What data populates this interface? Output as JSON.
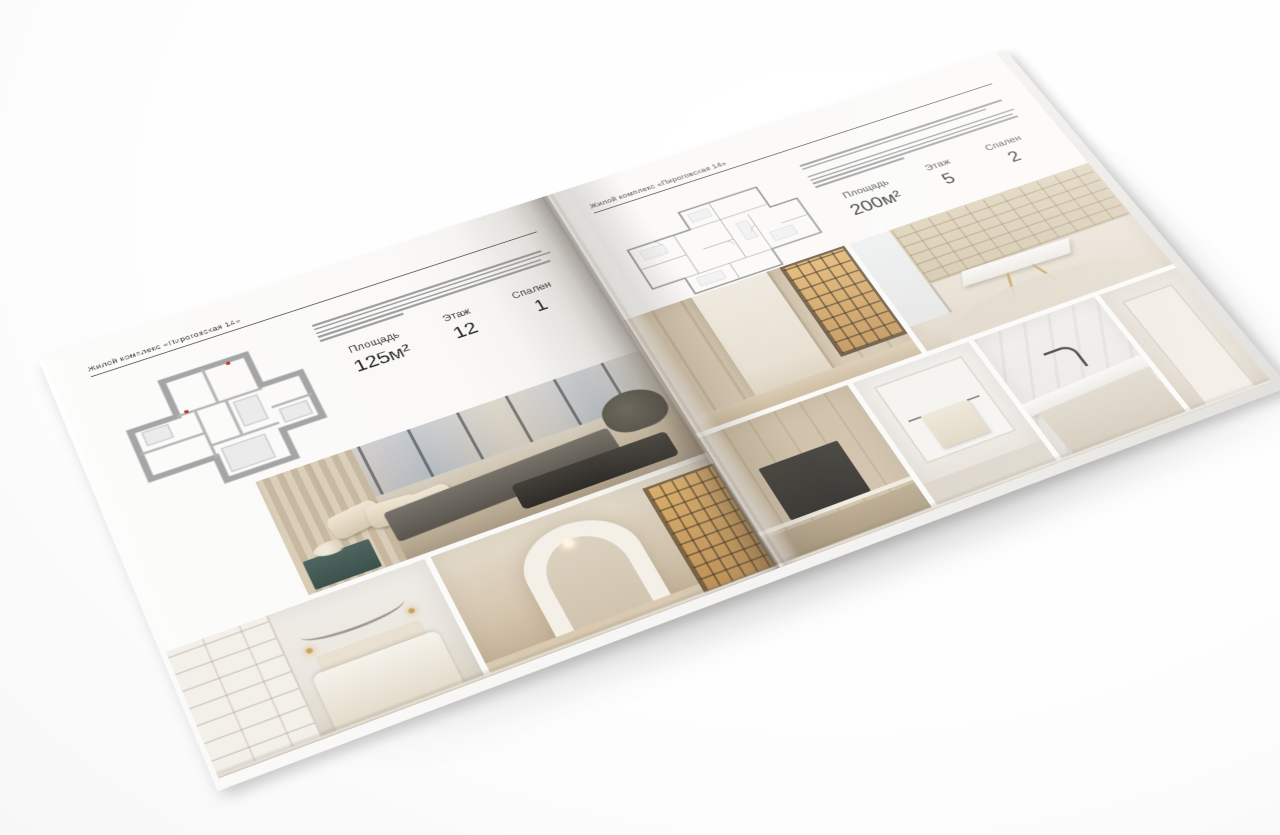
{
  "brochure": {
    "left_page": {
      "header": "Жилой комплекс «Пироговская 14»",
      "area_label": "Площадь",
      "area_value": "125м²",
      "floor_label": "Этаж",
      "floor_value": "12",
      "bedrooms_label": "Спален",
      "bedrooms_value": "1"
    },
    "right_page": {
      "header": "Жилой комплекс «Пироговская 14»",
      "area_label": "Площадь",
      "area_value": "200м²",
      "floor_label": "Этаж",
      "floor_value": "5",
      "bedrooms_label": "Спален",
      "bedrooms_value": "2"
    },
    "colors": {
      "page": "#fbfaf8",
      "plan_walls": "#a5a5a5",
      "amber_shelves": "#d8ab62",
      "photo_beige": "#cdbda6",
      "dark_furniture": "#35322d"
    }
  }
}
